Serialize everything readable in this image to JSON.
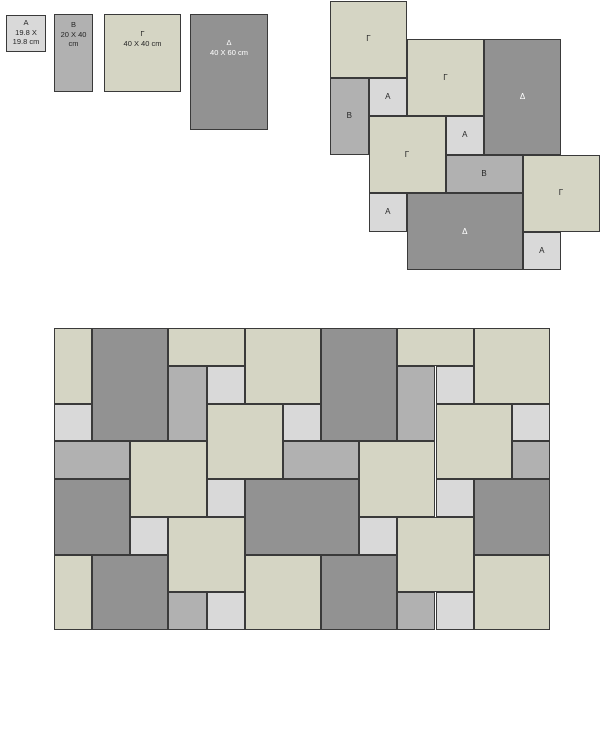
{
  "background": "#ffffff",
  "colors": {
    "A": "#d9d9d9",
    "B": "#b1b1b1",
    "G": "#d5d5c4",
    "D": "#929292",
    "border": "#3a3a3a",
    "label_dark": "#262626",
    "label_light": "#ffffff"
  },
  "legend": {
    "tiles": [
      {
        "type": "A",
        "lines": [
          "A",
          "19.8 X",
          "19.8 cm"
        ],
        "x": 6,
        "y": 15,
        "w": 40,
        "h": 37,
        "pad": 2
      },
      {
        "type": "B",
        "lines": [
          "B",
          "20 X 40",
          "cm"
        ],
        "x": 54,
        "y": 14,
        "w": 39,
        "h": 78,
        "pad": 5
      },
      {
        "type": "G",
        "lines": [
          "Γ",
          "40 X 40 cm"
        ],
        "x": 104,
        "y": 14,
        "w": 77,
        "h": 78,
        "pad": 14
      },
      {
        "type": "D",
        "lines": [
          "Δ",
          "40 X 60 cm"
        ],
        "x": 190,
        "y": 14,
        "w": 78,
        "h": 116,
        "pad": 23
      }
    ]
  },
  "module": {
    "x": 330,
    "y": 0.5,
    "unit": 38.5,
    "tiles": [
      {
        "type": "G",
        "label": "Γ",
        "c": 0,
        "r": 0,
        "w": 2,
        "h": 2
      },
      {
        "type": "G",
        "label": "Γ",
        "c": 2,
        "r": 1,
        "w": 2,
        "h": 2
      },
      {
        "type": "D",
        "label": "Δ",
        "c": 4,
        "r": 1,
        "w": 2,
        "h": 3
      },
      {
        "type": "B",
        "label": "B",
        "c": 0,
        "r": 2,
        "w": 1,
        "h": 2
      },
      {
        "type": "A",
        "label": "A",
        "c": 1,
        "r": 2,
        "w": 1,
        "h": 1
      },
      {
        "type": "G",
        "label": "Γ",
        "c": 1,
        "r": 3,
        "w": 2,
        "h": 2
      },
      {
        "type": "A",
        "label": "A",
        "c": 3,
        "r": 3,
        "w": 1,
        "h": 1
      },
      {
        "type": "B",
        "label": "B",
        "c": 3,
        "r": 4,
        "w": 2,
        "h": 1
      },
      {
        "type": "G",
        "label": "Γ",
        "c": 5,
        "r": 4,
        "w": 2,
        "h": 2
      },
      {
        "type": "A",
        "label": "A",
        "c": 1,
        "r": 5,
        "w": 1,
        "h": 1
      },
      {
        "type": "D",
        "label": "Δ",
        "c": 2,
        "r": 5,
        "w": 3,
        "h": 2
      },
      {
        "type": "A",
        "label": "A",
        "c": 5,
        "r": 6,
        "w": 1,
        "h": 1
      }
    ]
  },
  "floor": {
    "x": 54,
    "y": 328,
    "unit_x": 38.15,
    "unit_y": 37.75,
    "cols": 13,
    "rows": 8,
    "tiles": [
      {
        "type": "G",
        "c": 0,
        "r": 0,
        "w": 1,
        "h": 2
      },
      {
        "type": "D",
        "c": 1,
        "r": 0,
        "w": 2,
        "h": 3
      },
      {
        "type": "G",
        "c": 3,
        "r": 0,
        "w": 2,
        "h": 1
      },
      {
        "type": "B",
        "c": 3,
        "r": 1,
        "w": 1,
        "h": 2
      },
      {
        "type": "A",
        "c": 4,
        "r": 1,
        "w": 1,
        "h": 1
      },
      {
        "type": "G",
        "c": 4,
        "r": 2,
        "w": 2,
        "h": 2
      },
      {
        "type": "G",
        "c": 5,
        "r": 0,
        "w": 2,
        "h": 2
      },
      {
        "type": "A",
        "c": 6,
        "r": 2,
        "w": 1,
        "h": 1
      },
      {
        "type": "D",
        "c": 7,
        "r": 0,
        "w": 2,
        "h": 3
      },
      {
        "type": "B",
        "c": 6,
        "r": 3,
        "w": 2,
        "h": 1
      },
      {
        "type": "G",
        "c": 9,
        "r": 0,
        "w": 2,
        "h": 1
      },
      {
        "type": "B",
        "c": 9,
        "r": 1,
        "w": 1,
        "h": 2
      },
      {
        "type": "A",
        "c": 10,
        "r": 1,
        "w": 1,
        "h": 1
      },
      {
        "type": "G",
        "c": 11,
        "r": 0,
        "w": 2,
        "h": 2
      },
      {
        "type": "G",
        "c": 10,
        "r": 2,
        "w": 2,
        "h": 2
      },
      {
        "type": "A",
        "c": 12,
        "r": 2,
        "w": 1,
        "h": 1
      },
      {
        "type": "B",
        "c": 12,
        "r": 3,
        "w": 1,
        "h": 1
      },
      {
        "type": "A",
        "c": 0,
        "r": 2,
        "w": 1,
        "h": 1
      },
      {
        "type": "B",
        "c": 0,
        "r": 3,
        "w": 2,
        "h": 1
      },
      {
        "type": "G",
        "c": 2,
        "r": 3,
        "w": 2,
        "h": 2
      },
      {
        "type": "D",
        "c": 0,
        "r": 4,
        "w": 2,
        "h": 2
      },
      {
        "type": "A",
        "c": 2,
        "r": 5,
        "w": 1,
        "h": 1
      },
      {
        "type": "G",
        "c": 3,
        "r": 5,
        "w": 2,
        "h": 2
      },
      {
        "type": "A",
        "c": 4,
        "r": 4,
        "w": 1,
        "h": 1
      },
      {
        "type": "D",
        "c": 5,
        "r": 4,
        "w": 3,
        "h": 2
      },
      {
        "type": "A",
        "c": 8,
        "r": 5,
        "w": 1,
        "h": 1
      },
      {
        "type": "G",
        "c": 8,
        "r": 3,
        "w": 2,
        "h": 2
      },
      {
        "type": "A",
        "c": 10,
        "r": 4,
        "w": 1,
        "h": 1
      },
      {
        "type": "D",
        "c": 11,
        "r": 4,
        "w": 2,
        "h": 2
      },
      {
        "type": "G",
        "c": 9,
        "r": 5,
        "w": 2,
        "h": 2
      },
      {
        "type": "G",
        "c": 0,
        "r": 6,
        "w": 1,
        "h": 2
      },
      {
        "type": "D",
        "c": 1,
        "r": 6,
        "w": 2,
        "h": 2
      },
      {
        "type": "B",
        "c": 3,
        "r": 7,
        "w": 1,
        "h": 1
      },
      {
        "type": "A",
        "c": 4,
        "r": 7,
        "w": 1,
        "h": 1
      },
      {
        "type": "G",
        "c": 5,
        "r": 6,
        "w": 2,
        "h": 2
      },
      {
        "type": "D",
        "c": 7,
        "r": 6,
        "w": 2,
        "h": 2
      },
      {
        "type": "B",
        "c": 9,
        "r": 7,
        "w": 1,
        "h": 1
      },
      {
        "type": "A",
        "c": 10,
        "r": 7,
        "w": 1,
        "h": 1
      },
      {
        "type": "G",
        "c": 11,
        "r": 6,
        "w": 2,
        "h": 2
      }
    ]
  }
}
